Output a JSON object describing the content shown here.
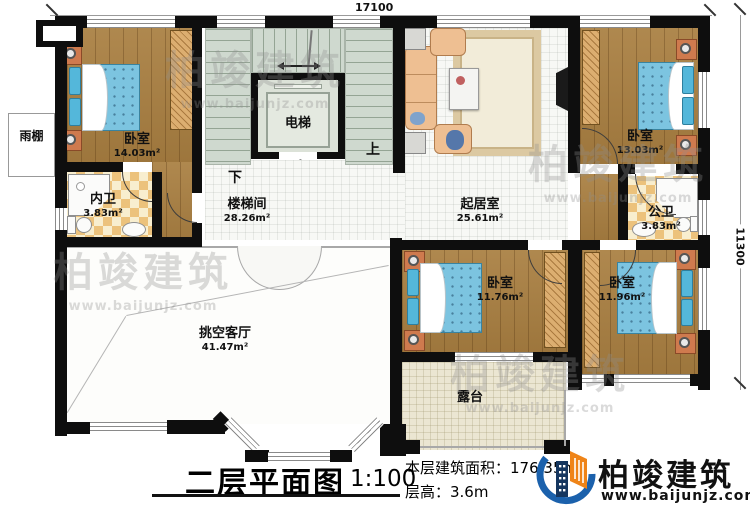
{
  "plan": {
    "dimensions": {
      "top": "17100",
      "right": "11300"
    },
    "rooms": [
      {
        "id": "bedroom-top-left",
        "name": "卧室",
        "area": "14.03m²"
      },
      {
        "id": "bedroom-top-right",
        "name": "卧室",
        "area": "13.03m²"
      },
      {
        "id": "bedroom-bottom-left",
        "name": "卧室",
        "area": "11.76m²"
      },
      {
        "id": "bedroom-bottom-right",
        "name": "卧室",
        "area": "11.96m²"
      },
      {
        "id": "stairwell",
        "name": "楼梯间",
        "area": "28.26m²"
      },
      {
        "id": "living-room",
        "name": "起居室",
        "area": "25.61m²"
      },
      {
        "id": "double-height-hall",
        "name": "挑空客厅",
        "area": "41.47m²"
      },
      {
        "id": "private-bath",
        "name": "内卫",
        "area": "3.83m²"
      },
      {
        "id": "public-bath",
        "name": "公卫",
        "area": "3.83m²"
      },
      {
        "id": "elevator",
        "name": "电梯",
        "area": ""
      },
      {
        "id": "terrace",
        "name": "露台",
        "area": ""
      },
      {
        "id": "rain-canopy",
        "name": "雨棚",
        "area": ""
      }
    ],
    "stairs": {
      "up": "上",
      "down": "下"
    }
  },
  "titleblock": {
    "title": "二层平面图",
    "scale": "1:100",
    "area_line": "本层建筑面积：176.35m²",
    "height_line": "层高：3.6m"
  },
  "brand": {
    "name": "柏竣建筑",
    "url": "www.baijunjz.com"
  },
  "watermark": {
    "text": "柏竣建筑",
    "url": "www.baijunjz.com"
  }
}
